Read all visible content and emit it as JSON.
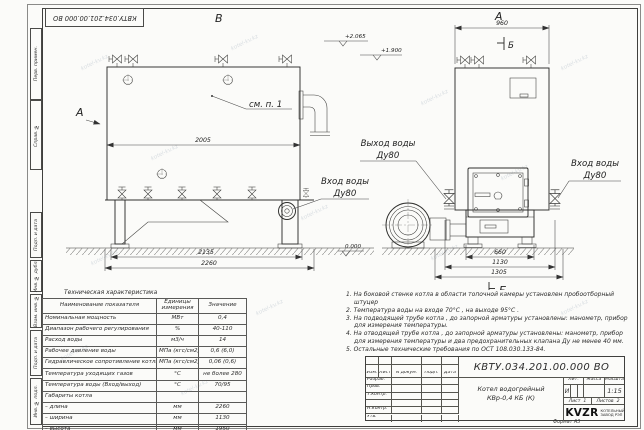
{
  "page": {
    "format_label": "Формат  А3"
  },
  "stamp": {
    "doc_number_flipped": "КВТУ.034.201.00.000  ВО"
  },
  "frame": {
    "left_stamps": [
      "Перв. примен.",
      "Справ. №",
      "Подп. и дата",
      "Инв. № дубл.",
      "Взам. инв. №",
      "Подп. и дата",
      "Инв. № подл."
    ]
  },
  "watermark": {
    "text": "kotel-kv.kz"
  },
  "views": {
    "view_b_label": "В",
    "view_a_label": "А",
    "view_dir_label": "А",
    "section_mark_top": "Б",
    "section_view_label": "Б",
    "callout": "см. п. 1",
    "outlet_line1": "Выход воды",
    "outlet_line2": "Ду80",
    "inlet_left_line1": "Вход воды",
    "inlet_left_line2": "Ду80",
    "inlet_right_line1": "Вход воды",
    "inlet_right_line2": "Ду80",
    "elev_top": "+2.065",
    "elev_mid": "+1.900",
    "elev_zero": "0.000",
    "dim_2005": "2005",
    "dim_2135": "2135",
    "dim_2260": "2260",
    "dim_960": "960",
    "dim_660": "660",
    "dim_1130": "1130",
    "dim_1305": "1305"
  },
  "tech_table": {
    "title": "Техническая характеристика",
    "headers": [
      "Наименование показателя",
      "Единицы измерения",
      "Значение"
    ],
    "rows": [
      [
        "Номинальная мощность",
        "МВт",
        "0,4"
      ],
      [
        "Диапазон рабочего регулирования",
        "%",
        "40-110"
      ],
      [
        "Расход воды",
        "м3/ч",
        "14"
      ],
      [
        "Рабочее давление воды",
        "МПа (кгс/см2)",
        "0,6 (6,0)"
      ],
      [
        "Гидравлическое сопротивление котла",
        "МПа (кгс/см2)",
        "0,06 (0,6)"
      ],
      [
        "Температура уходящих газов",
        "°С",
        "не более 280"
      ],
      [
        "Температура воды (Вход/выход)",
        "°С",
        "70/95"
      ],
      [
        "Габариты котла",
        "",
        ""
      ],
      [
        "– длина",
        "мм",
        "2260"
      ],
      [
        "– ширина",
        "мм",
        "1130"
      ],
      [
        "– высота",
        "мм",
        "1950"
      ]
    ]
  },
  "notes": {
    "items": [
      "1.  На боковой стенке котла в области топочной камеры установлен пробоотборный штуцер",
      "2.  Температура воды на входе  70°С ,  на выходе  95°С .",
      "3.  На подводящей трубе котла , до запорной арматуры установлены:  манометр,  прибор для измерения температуры.",
      "4.  На отводящей трубе котла , до запорной арматуры установлены:  манометр,  прибор для измерения температуры и два предохранительных клапана  Ду не менее  40 мм.",
      "5.  Остальные технические требования по ОСТ  108.030.133-84."
    ]
  },
  "title_block": {
    "header_cols": [
      "Изм.",
      "Лист",
      "N докум.",
      "Подп.",
      "Дата"
    ],
    "sign_rows": [
      "Разраб.",
      "Пров.",
      "Т.контр.",
      "",
      "Н.контр.",
      "Утв."
    ],
    "doc_number": "КВТУ.034.201.00.000  ВО",
    "product_line1": "Котел водогрейный",
    "product_line2": "КВр-0,4  КБ  (К)",
    "lit_label": "Лит.",
    "mass_label": "Масса",
    "scale_label": "Масштаб",
    "lit_value": "И",
    "scale_value": "1:15",
    "sheet_label": "Лист",
    "sheet_value": "1",
    "sheets_label": "Листов",
    "sheets_value": "2",
    "logo_text": "KVZR",
    "company_line1": "КОТЕЛЬНЫЙ",
    "company_line2": "ЗАВОД РЭП"
  }
}
